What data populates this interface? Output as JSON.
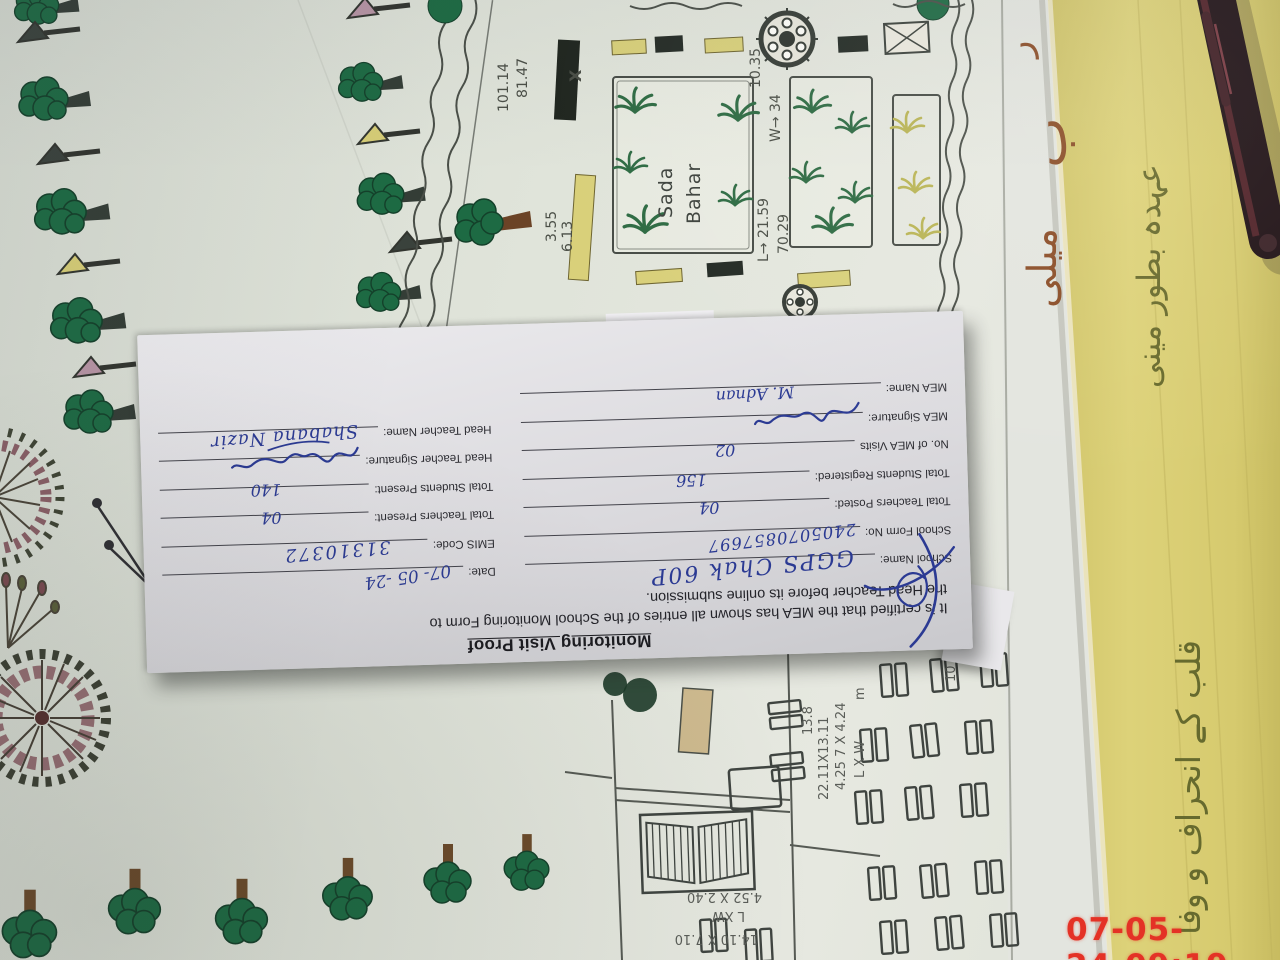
{
  "photo": {
    "timestamp": {
      "date": "07-05-24",
      "time": "09:19"
    }
  },
  "form": {
    "title": "Monitoring Visit Proof",
    "cert_line1": "It is certified that the MEA has shown all entries of the School Monitoring Form to",
    "cert_line2": "the Head Teacher before its online submission.",
    "rows": [
      {
        "left_label": "School Name:",
        "left_value": "GGPS Chak 60P",
        "right_label": "Date:",
        "right_value": "07- 05 -24"
      },
      {
        "left_label": "School Form No:",
        "left_value": "2405070857697",
        "right_label": "EMIS Code:",
        "right_value": "31310372"
      },
      {
        "left_label": "Total Teachers Posted:",
        "left_value": "04",
        "right_label": "Total Teachers Present:",
        "right_value": "04"
      },
      {
        "left_label": "Total Students Registered:",
        "left_value": "156",
        "right_label": "Total Students Present:",
        "right_value": "140"
      },
      {
        "left_label": "No. of MEA Visits",
        "left_value": "02",
        "right_label": "Head Teacher Signature:",
        "right_value": ""
      },
      {
        "left_label": "MEA Signature:",
        "left_value": "",
        "right_label": "Head Teacher Name:",
        "right_value": "Shabana Nazir"
      },
      {
        "left_label": "MEA Name:",
        "left_value": "M. Adnan",
        "right_label": "",
        "right_value": ""
      }
    ]
  },
  "map": {
    "labels": [
      "101.14",
      "81.47",
      "X",
      "3.55",
      "6.13",
      "L→ 21.59",
      "70.29",
      "W→ 34",
      "10.35",
      "Sada",
      "Bahar",
      "L XW",
      "4.52 X 2.40",
      "14.10 X 7.10",
      "L X W",
      "4.25 7 X 4.24",
      "13.8",
      "22.11X13.11",
      "m",
      "10 ="
    ]
  },
  "urdu": [
    "ر",
    "ب",
    "میلی",
    "عہدہ بطور مینی",
    "قلب کے انحراف و وفا"
  ],
  "colors": {
    "ink_blue": "#2b3a93",
    "timestamp_red": "#e43226",
    "tree_green": "#1d6a43",
    "bench_yellow": "#d9d07a",
    "paper_yellow": "#d7cb70",
    "plan_paper": "#dfe3da"
  }
}
